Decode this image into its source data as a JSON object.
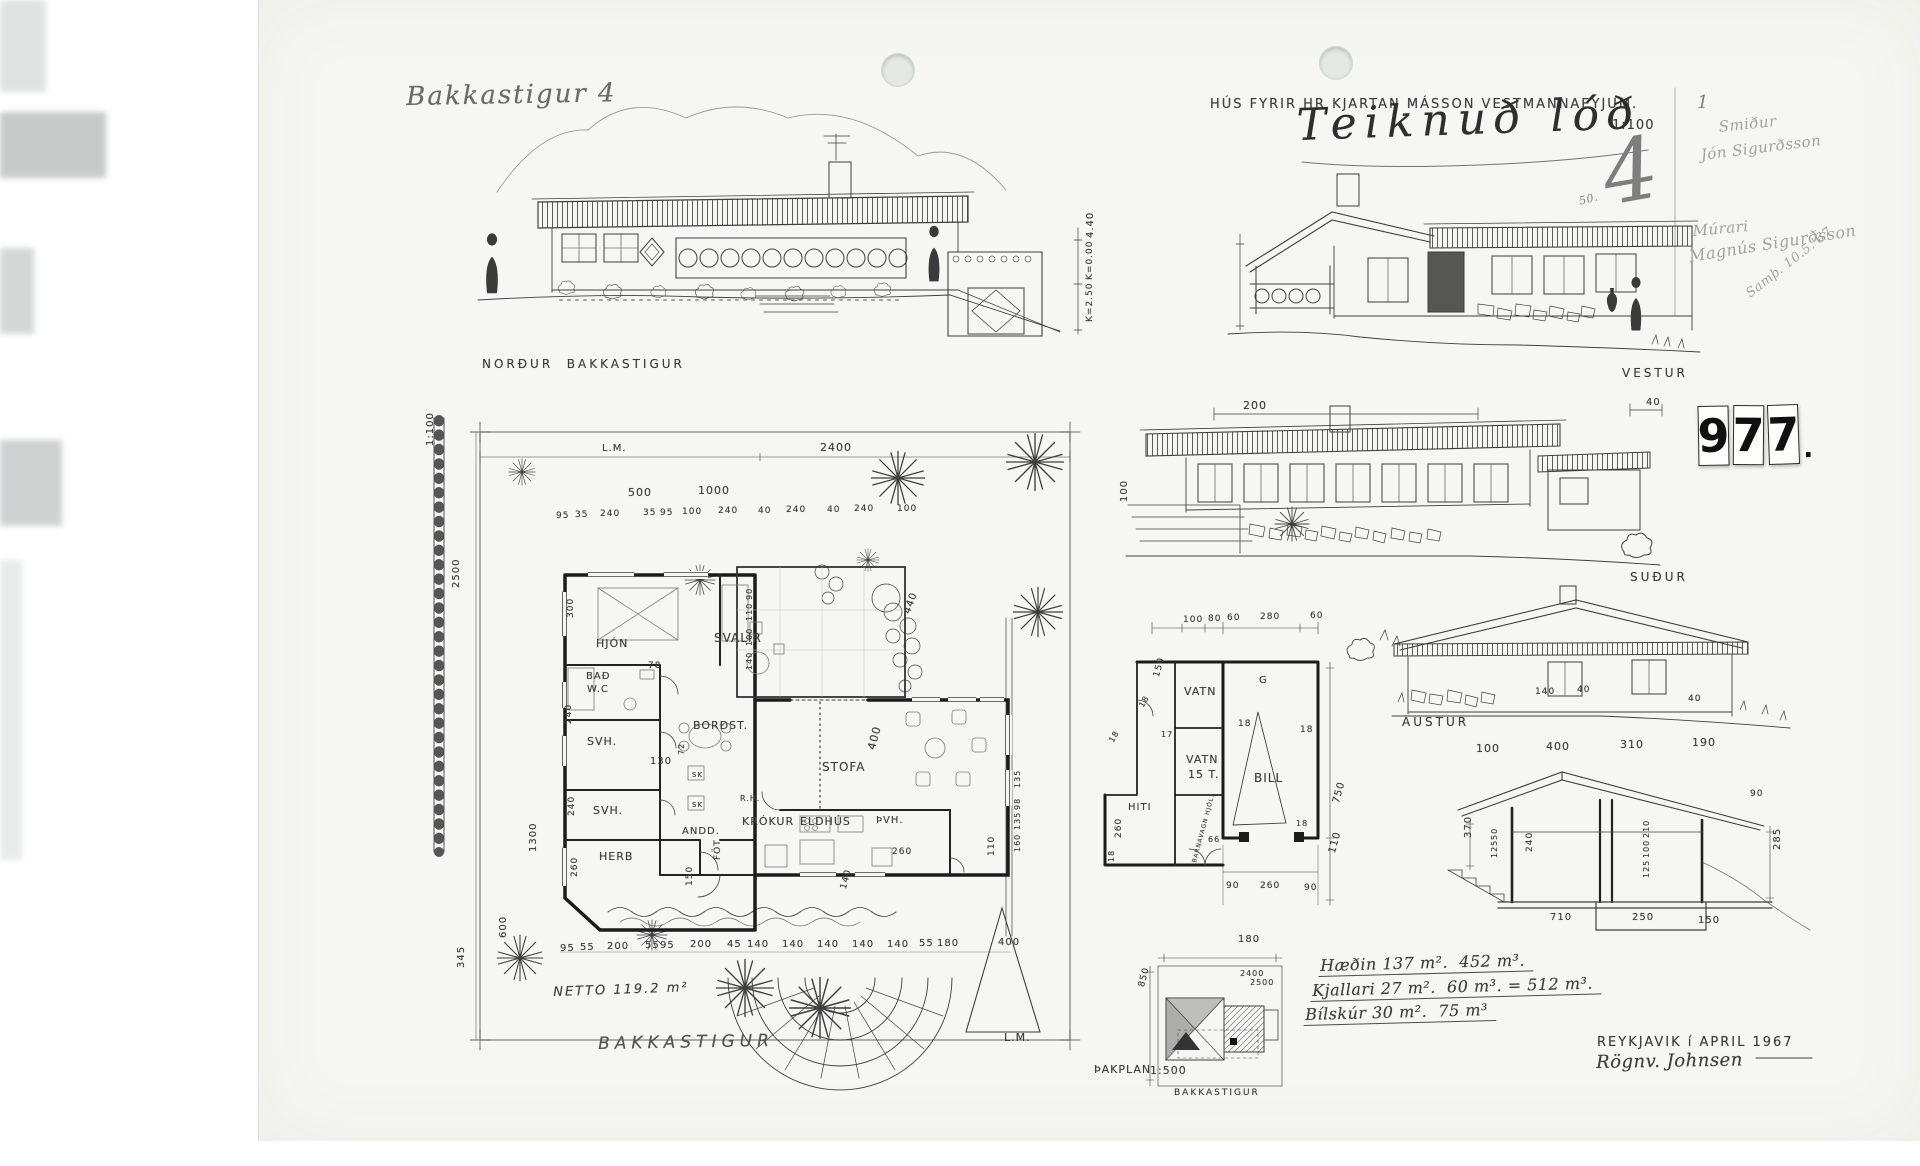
{
  "header": {
    "address": "Bakkastigur 4",
    "title": "HÚS FYRIR HR KJARTAN MÁSSON VESTMANNAEYJUM.",
    "scale": "1:100",
    "cursive_note": "Teiknuð lóð",
    "sheet_number": "4",
    "small_number": "50.",
    "margin_mark": "1",
    "archive_number": "977",
    "archive_digits": [
      "9",
      "7",
      "7"
    ],
    "archive_period": "."
  },
  "margin_notes": {
    "lines": [
      {
        "t": "Smiður",
        "x": 1718,
        "y": 120,
        "r": -6,
        "fs": 15,
        "cls": "hand faintp"
      },
      {
        "t": "Jón Sigurðsson",
        "x": 1700,
        "y": 148,
        "r": -7,
        "fs": 15,
        "cls": "hand faintp"
      },
      {
        "t": "Múrari",
        "x": 1692,
        "y": 224,
        "r": -5,
        "fs": 15,
        "cls": "hand faintp"
      },
      {
        "t": "Magnús Sigurðsson",
        "x": 1688,
        "y": 249,
        "r": -9,
        "fs": 16,
        "cls": "hand faintp"
      },
      {
        "t": "Samþ. 10.5.'67",
        "x": 1744,
        "y": 290,
        "r": -38,
        "fs": 13,
        "cls": "hand faintp"
      }
    ]
  },
  "elevations": {
    "north": "NORÐUR  BAKKASTIGUR",
    "west": "VESTUR",
    "south": "SUÐUR",
    "east": "AUSTUR"
  },
  "site_plan": {
    "street": "BAKKASTIGUR",
    "netto": "NETTO 119.2 m²",
    "lm_top": "L.M.",
    "lm_bottom": "L.M."
  },
  "roof_plan": {
    "label": "ÞAKPLAN",
    "scale": "1:500",
    "street": "BAKKASTIGUR"
  },
  "areas": {
    "line1": "Hæðin 137 m².  452 m³.",
    "line2": "Kjallari 27 m².  60 m³. = 512 m³.",
    "line3": "Bílskúr 30 m².  75 m³"
  },
  "footer": {
    "place_date": "REYKJAVIK í APRIL 1967",
    "signature": "Rögnv. Johnsen"
  },
  "rooms": [
    {
      "t": "HJÓN",
      "x": 596,
      "y": 638,
      "fs": 11
    },
    {
      "t": "BAÐ",
      "x": 586,
      "y": 672,
      "fs": 10
    },
    {
      "t": "W.C",
      "x": 587,
      "y": 685,
      "fs": 10
    },
    {
      "t": "SVH.",
      "x": 587,
      "y": 736,
      "fs": 11
    },
    {
      "t": "SVH.",
      "x": 593,
      "y": 805,
      "fs": 11
    },
    {
      "t": "HERB",
      "x": 599,
      "y": 851,
      "fs": 11
    },
    {
      "t": "SVALIR",
      "x": 714,
      "y": 632,
      "fs": 12
    },
    {
      "t": "BORÐST.",
      "x": 693,
      "y": 720,
      "fs": 11
    },
    {
      "t": "STOFA",
      "x": 822,
      "y": 761,
      "fs": 12
    },
    {
      "t": "ANDD.",
      "x": 682,
      "y": 827,
      "fs": 10
    },
    {
      "t": "FÖT",
      "x": 714,
      "y": 860,
      "r": -90,
      "fs": 9
    },
    {
      "t": "KRÓKUR",
      "x": 742,
      "y": 816,
      "fs": 11
    },
    {
      "t": "ELDHÚS",
      "x": 800,
      "y": 816,
      "fs": 11
    },
    {
      "t": "ÞVH.",
      "x": 876,
      "y": 816,
      "fs": 10
    },
    {
      "t": "SK",
      "x": 692,
      "y": 772,
      "fs": 7
    },
    {
      "t": "SK",
      "x": 692,
      "y": 802,
      "fs": 7
    },
    {
      "t": "R.H.",
      "x": 740,
      "y": 795,
      "fs": 8
    },
    {
      "t": "VATN",
      "x": 1184,
      "y": 686,
      "fs": 11
    },
    {
      "t": "VATN",
      "x": 1186,
      "y": 754,
      "fs": 11
    },
    {
      "t": "15 T.",
      "x": 1188,
      "y": 769,
      "fs": 11
    },
    {
      "t": "BILL",
      "x": 1254,
      "y": 772,
      "fs": 12
    },
    {
      "t": "G",
      "x": 1259,
      "y": 676,
      "fs": 10
    },
    {
      "t": "HITI",
      "x": 1128,
      "y": 803,
      "fs": 10
    },
    {
      "t": "BARNAVAGN HJÓL.",
      "x": 1192,
      "y": 862,
      "r": -75,
      "fs": 6
    }
  ],
  "dims": [
    {
      "t": "4.40",
      "x": 1086,
      "y": 238,
      "r": -90
    },
    {
      "t": "K=0.00",
      "x": 1086,
      "y": 280,
      "r": -90,
      "fs": 9
    },
    {
      "t": "K=2.50",
      "x": 1086,
      "y": 322,
      "r": -90,
      "fs": 9
    },
    {
      "t": "200",
      "x": 1243,
      "y": 400,
      "fs": 11
    },
    {
      "t": "40",
      "x": 1646,
      "y": 398
    },
    {
      "t": "100",
      "x": 1120,
      "y": 502,
      "r": -90
    },
    {
      "t": "140",
      "x": 1535,
      "y": 688,
      "fs": 9
    },
    {
      "t": "40",
      "x": 1577,
      "y": 686,
      "fs": 9
    },
    {
      "t": "40",
      "x": 1688,
      "y": 695,
      "fs": 9
    },
    {
      "t": "100",
      "x": 1476,
      "y": 743,
      "fs": 11
    },
    {
      "t": "400",
      "x": 1546,
      "y": 741,
      "fs": 11
    },
    {
      "t": "310",
      "x": 1620,
      "y": 739,
      "fs": 11
    },
    {
      "t": "190",
      "x": 1692,
      "y": 737,
      "fs": 11
    },
    {
      "t": "90",
      "x": 1750,
      "y": 790,
      "fs": 9
    },
    {
      "t": "370",
      "x": 1464,
      "y": 838,
      "r": -90
    },
    {
      "t": "50",
      "x": 1491,
      "y": 840,
      "r": -90,
      "fs": 8
    },
    {
      "t": "125",
      "x": 1491,
      "y": 858,
      "r": -90,
      "fs": 8
    },
    {
      "t": "240",
      "x": 1526,
      "y": 852,
      "r": -90,
      "fs": 9
    },
    {
      "t": "210",
      "x": 1643,
      "y": 838,
      "r": -90,
      "fs": 8
    },
    {
      "t": "100",
      "x": 1643,
      "y": 858,
      "r": -90,
      "fs": 8
    },
    {
      "t": "125",
      "x": 1643,
      "y": 878,
      "r": -90,
      "fs": 8
    },
    {
      "t": "285",
      "x": 1773,
      "y": 850,
      "r": -90
    },
    {
      "t": "710",
      "x": 1550,
      "y": 913
    },
    {
      "t": "250",
      "x": 1632,
      "y": 913
    },
    {
      "t": "150",
      "x": 1698,
      "y": 916
    },
    {
      "t": "2400",
      "x": 820,
      "y": 442,
      "fs": 11
    },
    {
      "t": "500",
      "x": 628,
      "y": 487,
      "fs": 11
    },
    {
      "t": "1000",
      "x": 698,
      "y": 485,
      "fs": 11
    },
    {
      "t": "95",
      "x": 556,
      "y": 512,
      "fs": 9
    },
    {
      "t": "35",
      "x": 575,
      "y": 511,
      "fs": 9
    },
    {
      "t": "240",
      "x": 600,
      "y": 510,
      "fs": 9
    },
    {
      "t": "35",
      "x": 643,
      "y": 509,
      "fs": 9
    },
    {
      "t": "95",
      "x": 660,
      "y": 509,
      "fs": 9
    },
    {
      "t": "100",
      "x": 682,
      "y": 508,
      "fs": 9
    },
    {
      "t": "240",
      "x": 718,
      "y": 507,
      "fs": 9
    },
    {
      "t": "40",
      "x": 758,
      "y": 507,
      "fs": 9
    },
    {
      "t": "240",
      "x": 786,
      "y": 506,
      "fs": 9
    },
    {
      "t": "40",
      "x": 827,
      "y": 506,
      "fs": 9
    },
    {
      "t": "240",
      "x": 854,
      "y": 505,
      "fs": 9
    },
    {
      "t": "100",
      "x": 897,
      "y": 505,
      "fs": 9
    },
    {
      "t": "2500",
      "x": 452,
      "y": 588,
      "r": -90
    },
    {
      "t": "1300",
      "x": 529,
      "y": 852,
      "r": -90
    },
    {
      "t": "600",
      "x": 499,
      "y": 938,
      "r": -90
    },
    {
      "t": "345",
      "x": 457,
      "y": 968,
      "r": -90
    },
    {
      "t": "1:100",
      "x": 426,
      "y": 446,
      "r": -90
    },
    {
      "t": "300",
      "x": 567,
      "y": 618,
      "r": -90,
      "fs": 9
    },
    {
      "t": "240",
      "x": 565,
      "y": 724,
      "r": -90,
      "fs": 9
    },
    {
      "t": "240",
      "x": 568,
      "y": 816,
      "r": -90,
      "fs": 9
    },
    {
      "t": "260",
      "x": 571,
      "y": 877,
      "r": -90,
      "fs": 9
    },
    {
      "t": "90",
      "x": 746,
      "y": 600,
      "r": -90,
      "fs": 8
    },
    {
      "t": "110",
      "x": 746,
      "y": 621,
      "r": -90,
      "fs": 8
    },
    {
      "t": "100",
      "x": 746,
      "y": 646,
      "r": -90,
      "fs": 8
    },
    {
      "t": "140",
      "x": 746,
      "y": 670,
      "r": -90,
      "fs": 8
    },
    {
      "t": "78",
      "x": 648,
      "y": 662,
      "fs": 9
    },
    {
      "t": "130",
      "x": 650,
      "y": 757
    },
    {
      "t": "72",
      "x": 678,
      "y": 755,
      "r": -90,
      "fs": 8
    },
    {
      "t": "440",
      "x": 903,
      "y": 612,
      "r": -70
    },
    {
      "t": "400",
      "x": 866,
      "y": 748,
      "r": -75,
      "fs": 11
    },
    {
      "t": "150",
      "x": 686,
      "y": 886,
      "r": -90,
      "fs": 9
    },
    {
      "t": "140",
      "x": 840,
      "y": 888,
      "r": -75,
      "fs": 9
    },
    {
      "t": "135",
      "x": 1014,
      "y": 788,
      "r": -90,
      "fs": 8
    },
    {
      "t": "98",
      "x": 1014,
      "y": 810,
      "r": -90,
      "fs": 8
    },
    {
      "t": "135",
      "x": 1014,
      "y": 830,
      "r": -90,
      "fs": 8
    },
    {
      "t": "160",
      "x": 1014,
      "y": 852,
      "r": -90,
      "fs": 8
    },
    {
      "t": "110",
      "x": 988,
      "y": 856,
      "r": -90,
      "fs": 9
    },
    {
      "t": "260",
      "x": 892,
      "y": 848,
      "fs": 9
    },
    {
      "t": "95",
      "x": 560,
      "y": 944
    },
    {
      "t": "55",
      "x": 580,
      "y": 943
    },
    {
      "t": "200",
      "x": 607,
      "y": 942
    },
    {
      "t": "55",
      "x": 645,
      "y": 941
    },
    {
      "t": "95",
      "x": 660,
      "y": 941
    },
    {
      "t": "200",
      "x": 690,
      "y": 940
    },
    {
      "t": "45",
      "x": 727,
      "y": 940
    },
    {
      "t": "140",
      "x": 747,
      "y": 940
    },
    {
      "t": "140",
      "x": 782,
      "y": 940
    },
    {
      "t": "140",
      "x": 817,
      "y": 940
    },
    {
      "t": "140",
      "x": 852,
      "y": 940
    },
    {
      "t": "140",
      "x": 887,
      "y": 940
    },
    {
      "t": "55",
      "x": 919,
      "y": 939
    },
    {
      "t": "180",
      "x": 937,
      "y": 939
    },
    {
      "t": "400",
      "x": 998,
      "y": 938
    },
    {
      "t": "100",
      "x": 1183,
      "y": 616,
      "fs": 9
    },
    {
      "t": "80",
      "x": 1208,
      "y": 615,
      "fs": 9
    },
    {
      "t": "60",
      "x": 1227,
      "y": 614,
      "fs": 9
    },
    {
      "t": "280",
      "x": 1260,
      "y": 613,
      "fs": 9
    },
    {
      "t": "60",
      "x": 1310,
      "y": 612,
      "fs": 9
    },
    {
      "t": "150",
      "x": 1153,
      "y": 676,
      "r": -75,
      "fs": 9
    },
    {
      "t": "18",
      "x": 1138,
      "y": 705,
      "r": -60,
      "fs": 8
    },
    {
      "t": "17",
      "x": 1161,
      "y": 731,
      "fs": 8
    },
    {
      "t": "18",
      "x": 1238,
      "y": 720,
      "fs": 9
    },
    {
      "t": "18",
      "x": 1300,
      "y": 726,
      "fs": 9
    },
    {
      "t": "18",
      "x": 1108,
      "y": 740,
      "r": -60,
      "fs": 8
    },
    {
      "t": "18",
      "x": 1296,
      "y": 820,
      "fs": 8
    },
    {
      "t": "66",
      "x": 1208,
      "y": 836,
      "fs": 8
    },
    {
      "t": "750",
      "x": 1332,
      "y": 802,
      "r": -75
    },
    {
      "t": "110",
      "x": 1328,
      "y": 852,
      "r": -75
    },
    {
      "t": "90",
      "x": 1226,
      "y": 882,
      "fs": 9
    },
    {
      "t": "260",
      "x": 1260,
      "y": 882,
      "fs": 9
    },
    {
      "t": "90",
      "x": 1304,
      "y": 884,
      "fs": 9
    },
    {
      "t": "180",
      "x": 1238,
      "y": 935
    },
    {
      "t": "260",
      "x": 1115,
      "y": 838,
      "r": -90,
      "fs": 9
    },
    {
      "t": "18",
      "x": 1108,
      "y": 862,
      "r": -90,
      "fs": 8
    },
    {
      "t": "850",
      "x": 1138,
      "y": 986,
      "r": -75,
      "fs": 9
    },
    {
      "t": "2400",
      "x": 1240,
      "y": 970,
      "fs": 8
    },
    {
      "t": "2500",
      "x": 1250,
      "y": 979,
      "fs": 8
    }
  ]
}
